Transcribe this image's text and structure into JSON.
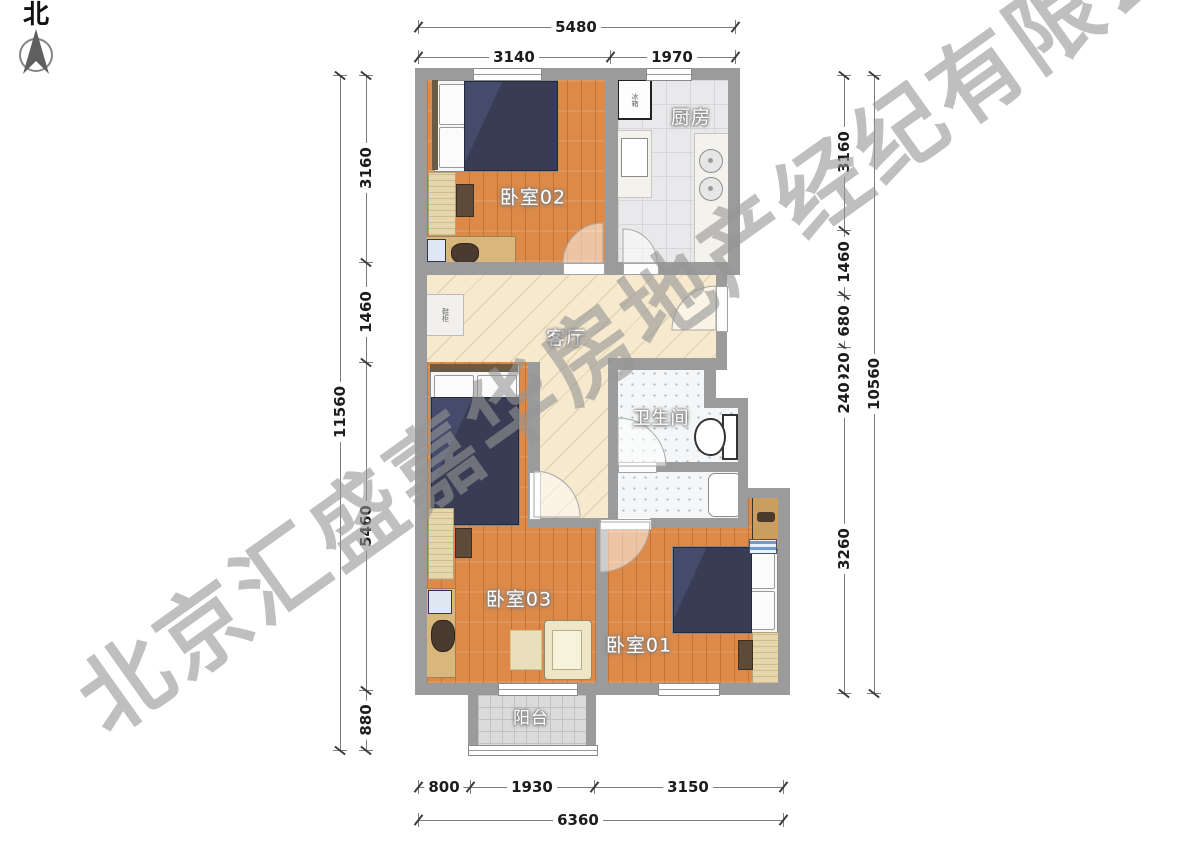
{
  "north_label": "北",
  "watermark": "北京汇盛嘉华房地产经纪有限公司",
  "rooms": {
    "bedroom02": "卧室02",
    "kitchen": "厨房",
    "living": "客厅",
    "bathroom": "卫生间",
    "bedroom03": "卧室03",
    "bedroom01": "卧室01",
    "balcony": "阳台"
  },
  "appliances": {
    "fridge": "冰箱",
    "cabinet": "鞋柜"
  },
  "dims": {
    "top": {
      "total": "5480",
      "seg1": "3140",
      "seg2": "1970"
    },
    "bottom": {
      "total": "6360",
      "seg1": "800",
      "seg2": "1930",
      "seg3": "3150"
    },
    "left": {
      "total": "11560",
      "seg1": "3160",
      "seg2": "1460",
      "seg3": "5460",
      "seg4": "880"
    },
    "right": {
      "total": "10560",
      "seg1": "3160",
      "seg2": "1460",
      "seg3": "680",
      "seg4": "920",
      "seg5": "240",
      "seg6": "3260"
    }
  }
}
